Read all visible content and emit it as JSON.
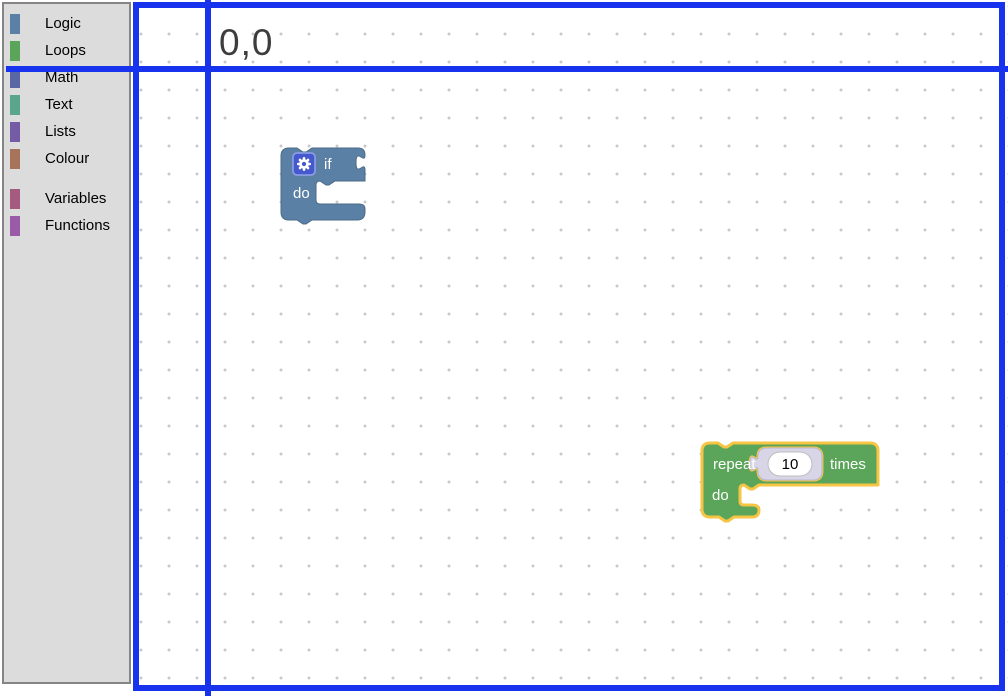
{
  "toolbox": {
    "categories": [
      {
        "label": "Logic",
        "color": "#5b80a5"
      },
      {
        "label": "Loops",
        "color": "#5ba55b"
      },
      {
        "label": "Math",
        "color": "#5b67a5"
      },
      {
        "label": "Text",
        "color": "#5ba58c"
      },
      {
        "label": "Lists",
        "color": "#745ba5"
      },
      {
        "label": "Colour",
        "color": "#a5745b"
      },
      {
        "label": "Variables",
        "color": "#a55b80"
      },
      {
        "label": "Functions",
        "color": "#995ba5"
      }
    ]
  },
  "workspace": {
    "grid_dot_color": "#c9c9c9",
    "if_block": {
      "type": "controls_if",
      "color": "#5b80a5",
      "border_color": "#4d6b88",
      "mutator_icon": "gear",
      "mutator_badge_color": "#4659cc",
      "label_if": "if",
      "label_do": "do"
    },
    "repeat_block": {
      "type": "controls_repeat",
      "color": "#5ba55b",
      "selected": true,
      "selection_color": "#f5c543",
      "label_repeat": "repeat",
      "value": "10",
      "label_times": "times",
      "label_do": "do",
      "shadow_color": "#d8d5e7"
    }
  },
  "annotation": {
    "origin_label": "0,0",
    "line_color": "#1733ee"
  }
}
